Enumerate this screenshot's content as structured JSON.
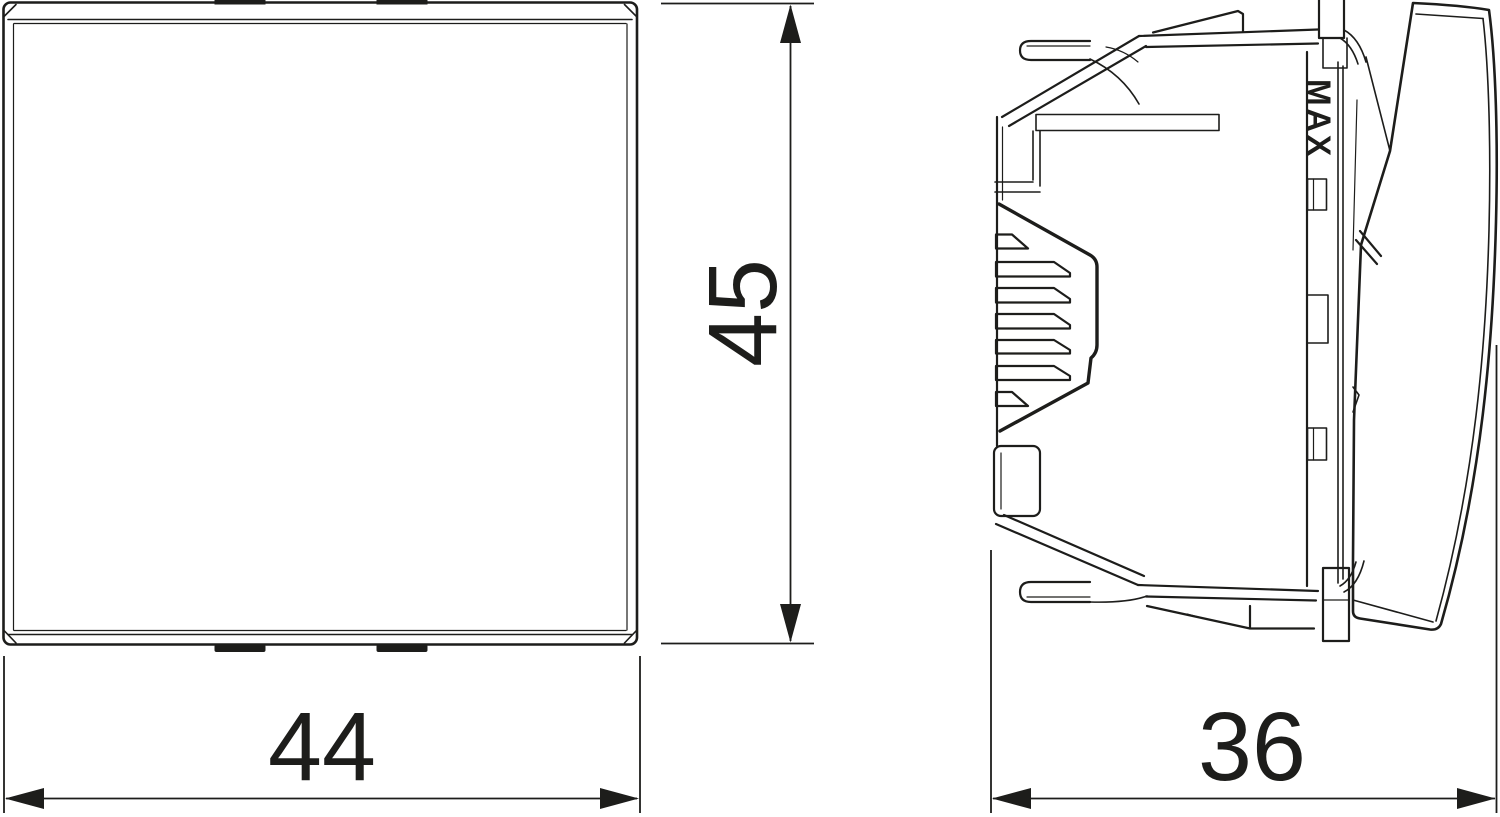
{
  "drawing": {
    "kind": "dimensioned-technical-line-drawing",
    "subject": "flush-mounted rocker switch module, front view and side view",
    "line_color": "#1d1d1b",
    "background_color": "#ffffff",
    "views": {
      "front": {
        "name": "front view (square rocker face)"
      },
      "side": {
        "name": "side view (switch insert with mounting claws and rocker)"
      }
    },
    "dimensions": {
      "width": {
        "value": "44",
        "unit_hint": "mm",
        "view": "front",
        "axis": "horizontal"
      },
      "height": {
        "value": "45",
        "unit_hint": "mm",
        "view": "front",
        "axis": "vertical"
      },
      "depth": {
        "value": "36",
        "unit_hint": "mm",
        "view": "side",
        "axis": "horizontal"
      }
    },
    "markings": {
      "max": "MAX"
    }
  }
}
